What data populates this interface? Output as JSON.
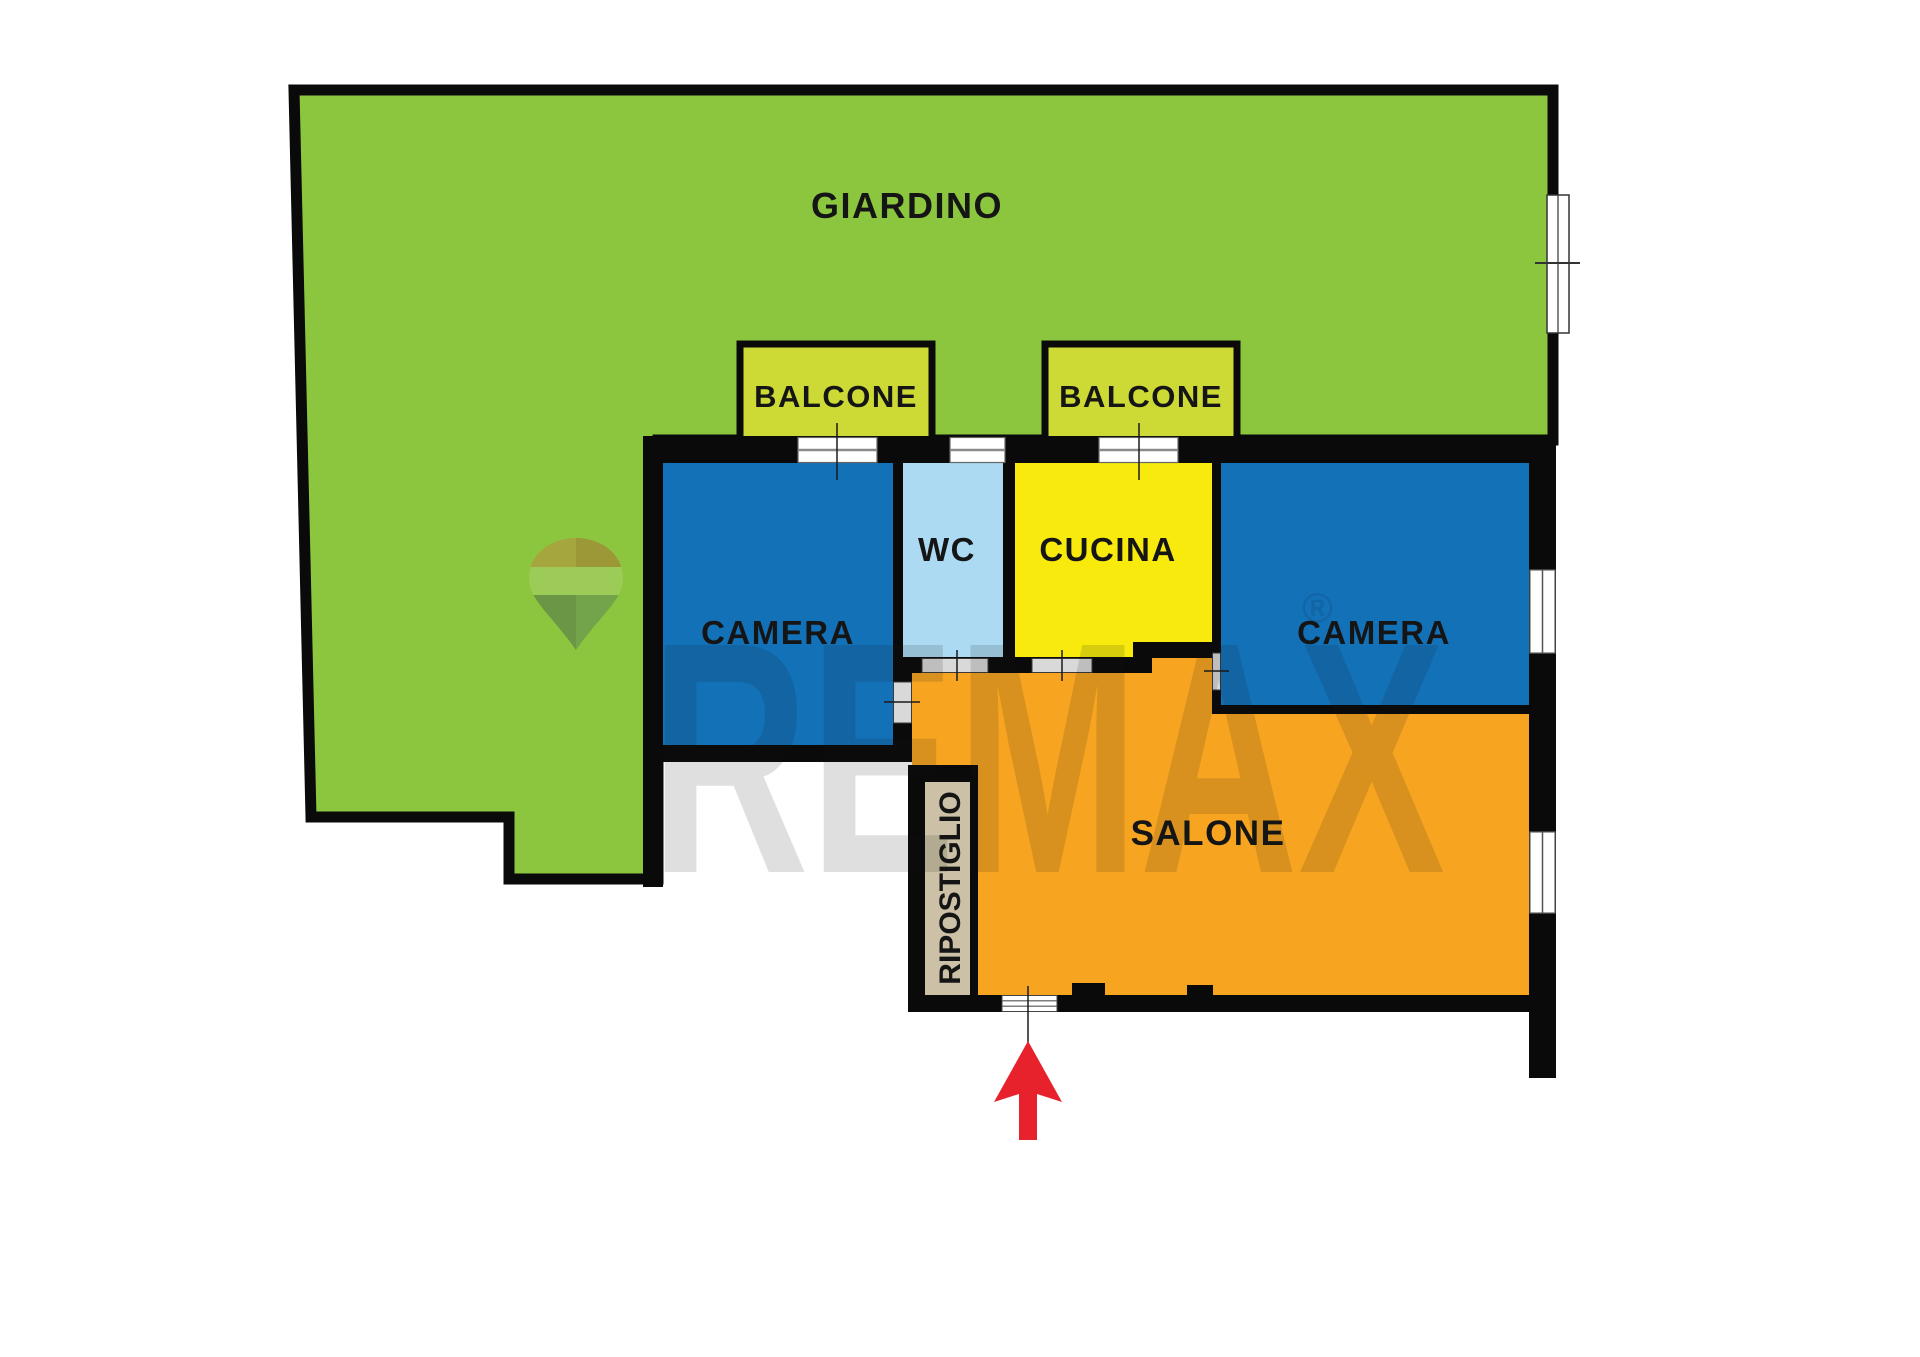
{
  "labels": {
    "giardino": "GIARDINO",
    "balcone_left": "BALCONE",
    "balcone_right": "BALCONE",
    "camera_left": "CAMERA",
    "camera_right": "CAMERA",
    "wc": "WC",
    "cucina": "CUCINA",
    "salone": "SALONE",
    "ripostiglio": "RIPOSTIGLIO"
  },
  "watermark": {
    "brand": "REMAX",
    "registered": "®"
  },
  "colors": {
    "giardino": "#8cc63f",
    "balcone": "#cdd934",
    "camera": "#1371b8",
    "wc": "#abdaf2",
    "cucina": "#f7ea0c",
    "salone": "#f7a521",
    "ripostiglio": "#ccc1a6",
    "wall": "#0a0a0a",
    "arrow": "#e8222d",
    "balloon_top": "#a5a63d",
    "balloon_stripe": "#9ccb57",
    "balloon_bottom": "#73a34b"
  }
}
